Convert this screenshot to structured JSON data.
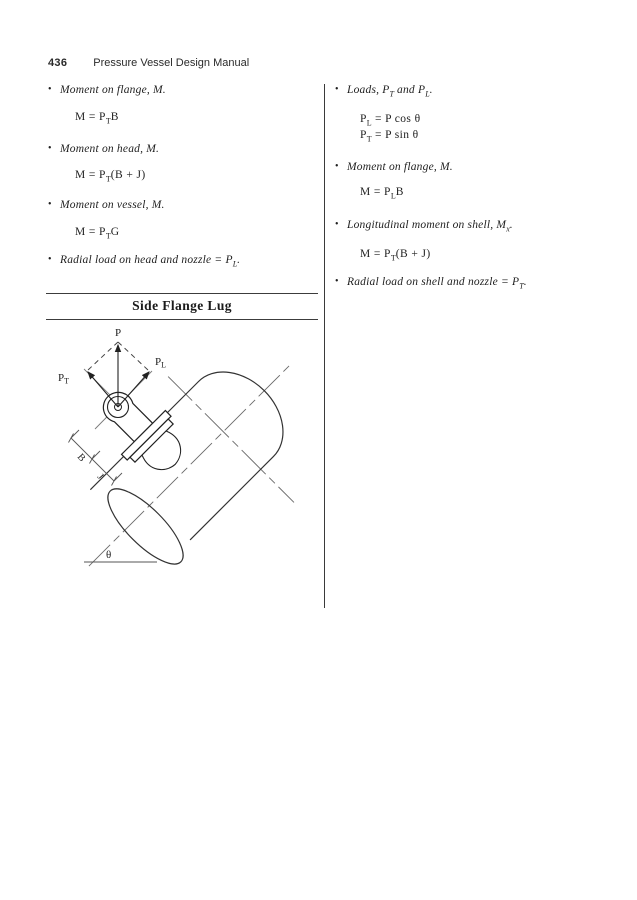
{
  "glyphs": {
    "bullet": "•"
  },
  "header": {
    "page_number": "436",
    "title": "Pressure Vessel Design Manual"
  },
  "left_column": {
    "items": [
      {
        "kind": "bullet",
        "segments": [
          {
            "t": "Moment on flange, M."
          }
        ]
      },
      {
        "kind": "equation",
        "segments": [
          {
            "t": "M = P"
          },
          {
            "t": "T",
            "sub": true
          },
          {
            "t": "B"
          }
        ]
      },
      {
        "kind": "bullet",
        "segments": [
          {
            "t": "Moment on head, M."
          }
        ]
      },
      {
        "kind": "equation",
        "segments": [
          {
            "t": "M = P"
          },
          {
            "t": "T",
            "sub": true
          },
          {
            "t": "(B + J)"
          }
        ]
      },
      {
        "kind": "bullet",
        "segments": [
          {
            "t": "Moment on vessel, M."
          }
        ]
      },
      {
        "kind": "equation",
        "segments": [
          {
            "t": "M = P"
          },
          {
            "t": "T",
            "sub": true
          },
          {
            "t": "G"
          }
        ]
      },
      {
        "kind": "bullet",
        "segments": [
          {
            "t": "Radial load on head and nozzle = P"
          },
          {
            "t": "L",
            "sub": true
          },
          {
            "t": "."
          }
        ]
      }
    ]
  },
  "right_column": {
    "items": [
      {
        "kind": "bullet",
        "segments": [
          {
            "t": "Loads, P"
          },
          {
            "t": "T",
            "sub": true
          },
          {
            "t": " and P"
          },
          {
            "t": "L",
            "sub": true
          },
          {
            "t": "."
          }
        ]
      },
      {
        "kind": "equation",
        "segments": [
          {
            "t": "P"
          },
          {
            "t": "L",
            "sub": true
          },
          {
            "t": " = P cos θ"
          }
        ]
      },
      {
        "kind": "equation",
        "segments": [
          {
            "t": "P"
          },
          {
            "t": "T",
            "sub": true
          },
          {
            "t": " = P sin θ"
          }
        ]
      },
      {
        "kind": "bullet",
        "segments": [
          {
            "t": "Moment on flange, M."
          }
        ]
      },
      {
        "kind": "equation",
        "segments": [
          {
            "t": "M = P"
          },
          {
            "t": "L",
            "sub": true
          },
          {
            "t": "B"
          }
        ]
      },
      {
        "kind": "bullet",
        "segments": [
          {
            "t": "Longitudinal moment on shell, M"
          },
          {
            "t": "x",
            "sub": true
          },
          {
            "t": "."
          }
        ]
      },
      {
        "kind": "equation",
        "segments": [
          {
            "t": "M = P"
          },
          {
            "t": "T",
            "sub": true
          },
          {
            "t": "(B + J)"
          }
        ]
      },
      {
        "kind": "bullet",
        "segments": [
          {
            "t": "Radial load on shell and nozzle = P"
          },
          {
            "t": "T",
            "sub": true
          },
          {
            "t": "."
          }
        ]
      }
    ]
  },
  "figure": {
    "title": "Side Flange Lug",
    "labels": {
      "p": "P",
      "pt_main": "P",
      "pt_sub": "T",
      "pl_main": "P",
      "pl_sub": "L",
      "b": "B",
      "j": "J",
      "theta": "θ"
    }
  }
}
